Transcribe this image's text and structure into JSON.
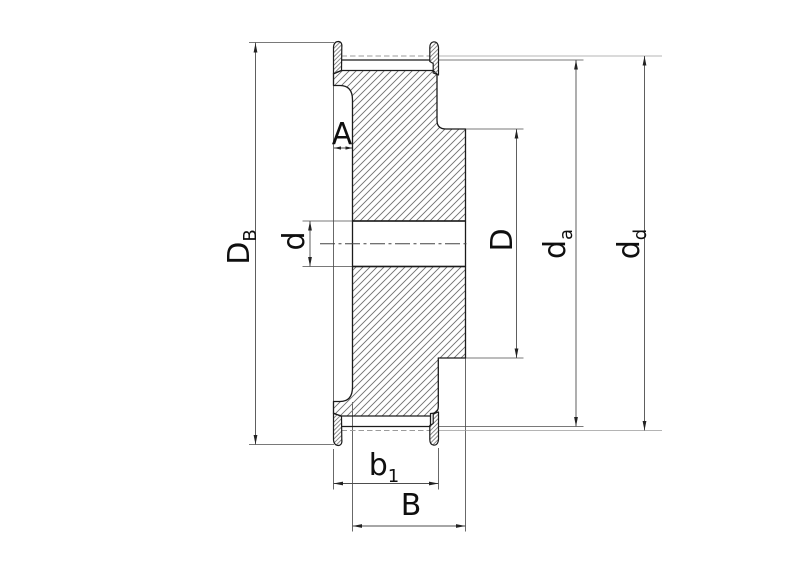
{
  "drawing": {
    "title": "timing-belt-pulley-cross-section",
    "dims": {
      "DB": {
        "main": "D",
        "sub": "B"
      },
      "d": {
        "main": "d",
        "sub": ""
      },
      "A": {
        "main": "A",
        "sub": ""
      },
      "D": {
        "main": "D",
        "sub": ""
      },
      "da": {
        "main": "d",
        "sub": "a"
      },
      "dd": {
        "main": "d",
        "sub": "d"
      },
      "b1": {
        "main": "b",
        "sub": "1"
      },
      "B": {
        "main": "B",
        "sub": ""
      }
    },
    "colors": {
      "background": "#ffffff",
      "outline": "#1b1b1b",
      "hatch": "#6f6f6f",
      "dimension_lines": "#4d4d4d",
      "pitch_line": "#9b9b9b",
      "text": "#0f0f0f"
    }
  }
}
